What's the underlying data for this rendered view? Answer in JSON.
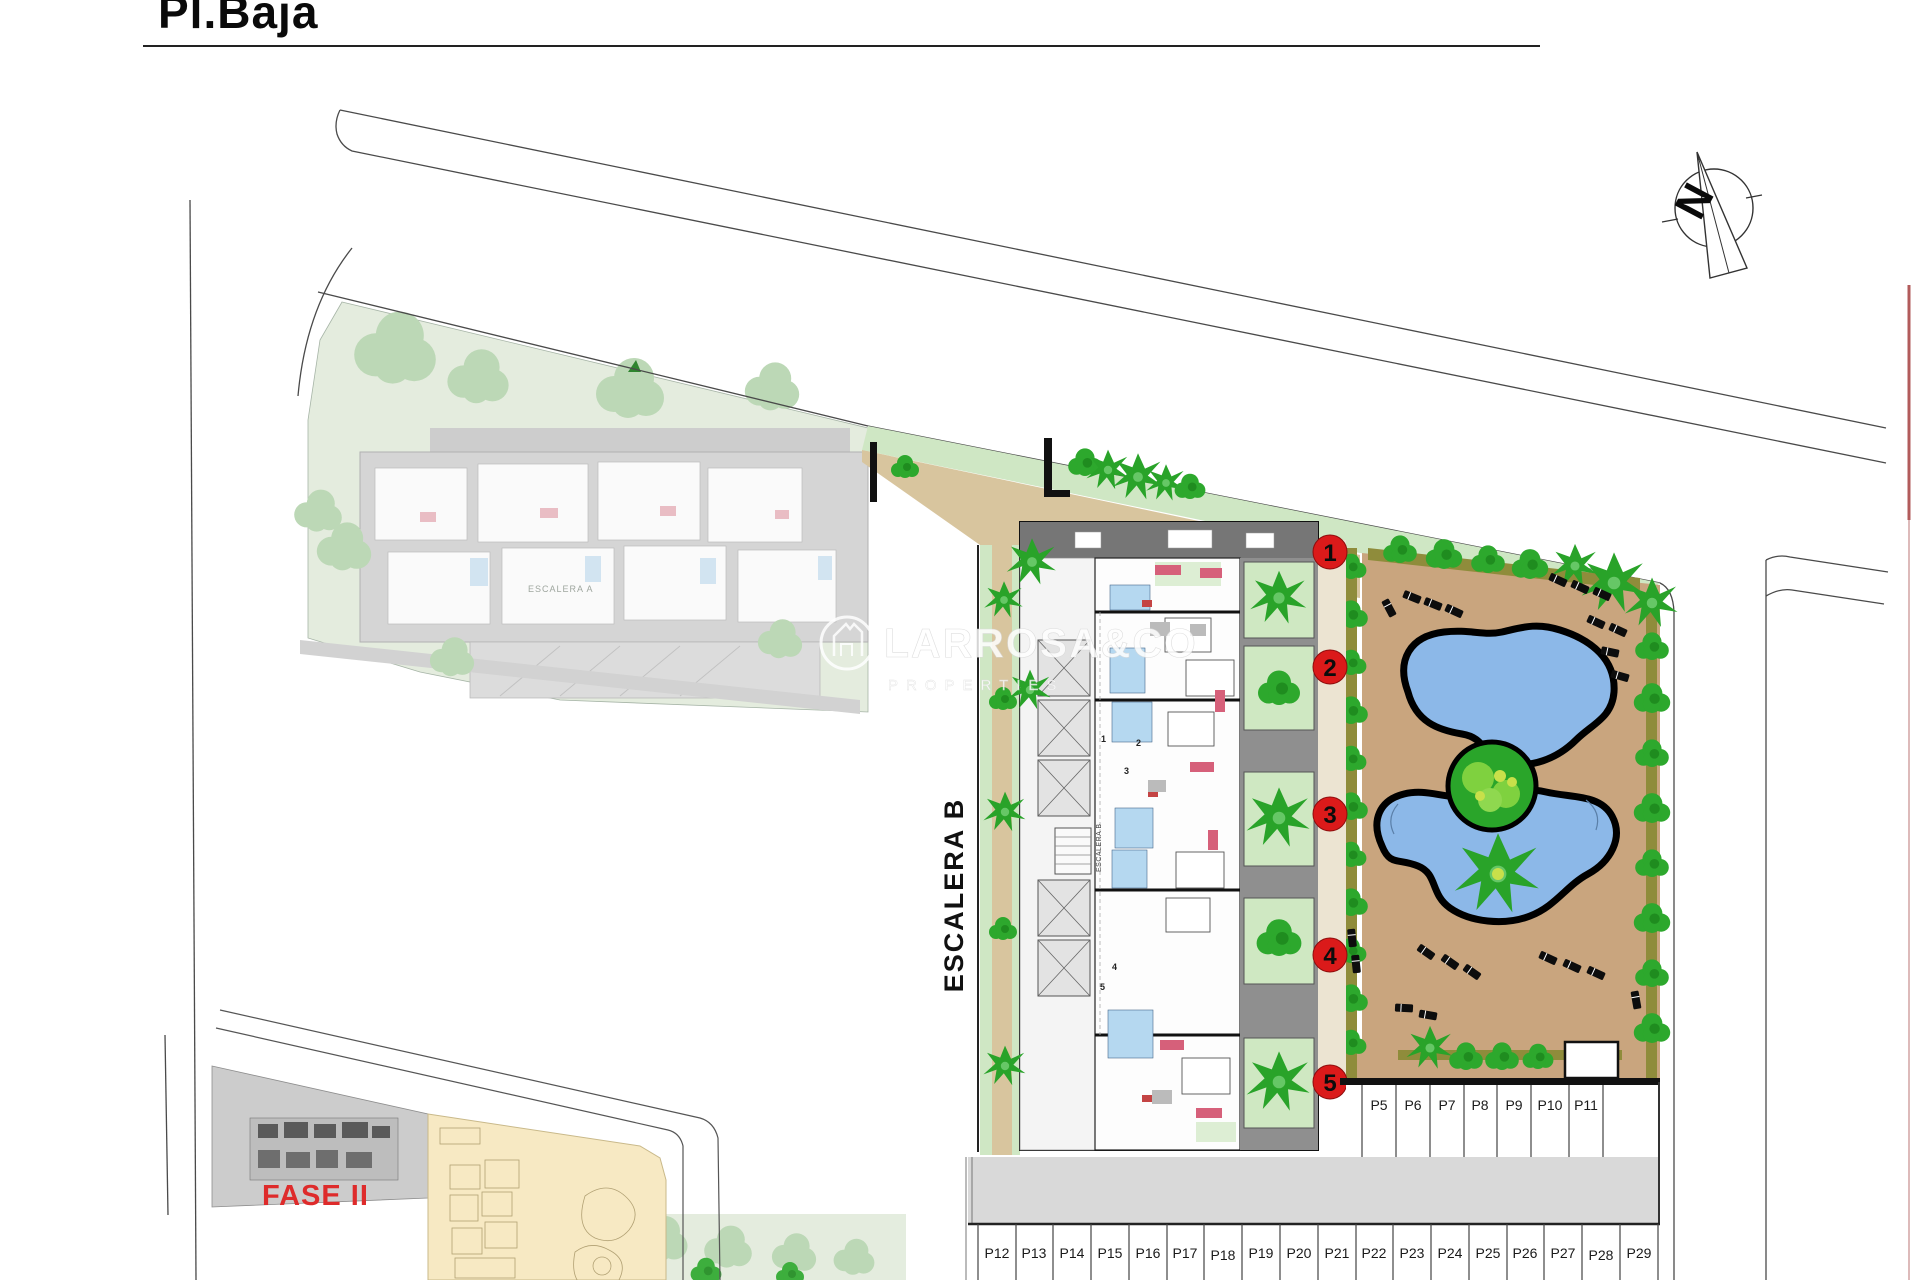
{
  "header": {
    "title": "Pl.Baja"
  },
  "compass": {
    "north_letter": "N"
  },
  "watermark": {
    "brand": "LARROSA&CO",
    "tagline": "PROPERTIES"
  },
  "site": {
    "stair_block_b_label": "ESCALERA B",
    "stair_block_b_inner_label": "ESCALERA B",
    "stair_block_a_label": "ESCALERA A",
    "phase_label": "FASE II",
    "unit_markers": [
      "1",
      "2",
      "3",
      "4",
      "5"
    ],
    "door_numbers": [
      "1",
      "2",
      "3",
      "4",
      "5"
    ]
  },
  "parking": {
    "row_right": [
      "P5",
      "P6",
      "P7",
      "P8",
      "P9",
      "P10",
      "P11"
    ],
    "row_bottom": [
      "P12",
      "P13",
      "P14",
      "P15",
      "P16",
      "P17",
      "P18",
      "P19",
      "P20",
      "P21",
      "P22",
      "P23",
      "P24",
      "P25",
      "P26",
      "P27",
      "P28",
      "P29"
    ]
  },
  "colors": {
    "marker_red": "#DB1A1A",
    "fase2_red": "#DE2B2B",
    "pool_blue": "#8CB8E8",
    "sand": "#C9A57E",
    "plaza_sand": "#D8C59E",
    "vegetation_green": "#2AA52A",
    "lawn_green": "#CFE7C4",
    "faded_lawn": "#E2EBDC",
    "phase1_yellow": "#F7E9C3",
    "road_gray": "#D9D9D9"
  }
}
